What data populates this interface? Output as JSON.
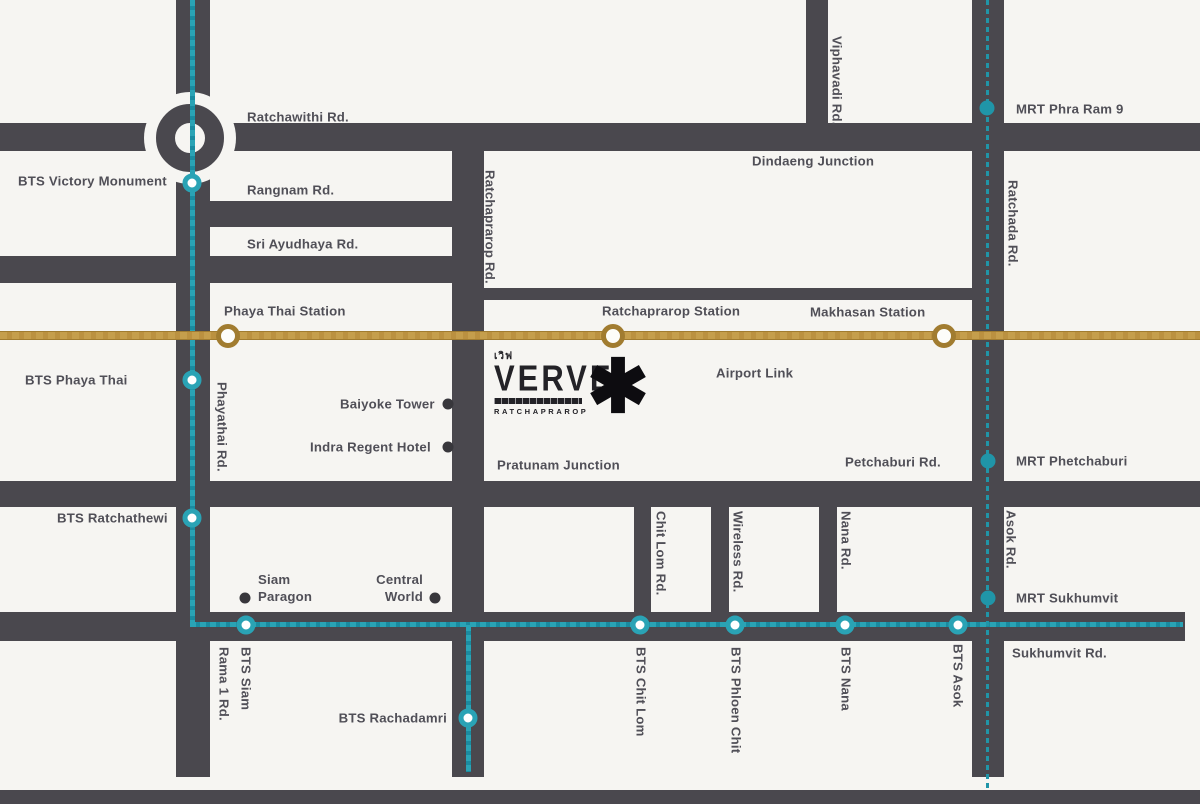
{
  "colors": {
    "road": "#4a484e",
    "bts": "#2aa3b5",
    "bts_dark": "#1a8ba0",
    "mrt": "#2095a8",
    "gold": "#bb9140",
    "gold_dark": "#a17c30",
    "text": "#504f57",
    "poi": "#38373c",
    "bg": "#f6f5f2",
    "logo_dark": "#232227"
  },
  "logo": {
    "thai": "เวิฟ",
    "name": "VERVE",
    "subtitle": "RATCHAPRAROP",
    "marker": "✱"
  },
  "labels": {
    "bts_victory_monument": "BTS Victory Monument",
    "ratchawithi_rd": "Ratchawithi Rd.",
    "rangnam_rd": "Rangnam Rd.",
    "sri_ayudhaya_rd": "Sri Ayudhaya Rd.",
    "viphavadi_rd": "Viphavadi Rd.",
    "mrt_phra_ram_9": "MRT Phra Ram 9",
    "dindaeng_junction": "Dindaeng Junction",
    "ratchada_rd": "Ratchada Rd.",
    "phaya_thai_station": "Phaya Thai Station",
    "ratchaprarop_station": "Ratchaprarop Station",
    "makhasan_station": "Makhasan Station",
    "airport_link": "Airport Link",
    "bts_phaya_thai": "BTS Phaya Thai",
    "phayathai_rd": "Phayathai Rd.",
    "ratchaprarop_rd": "Ratchaprarop Rd.",
    "baiyoke_tower": "Baiyoke Tower",
    "indra_regent_hotel": "Indra Regent Hotel",
    "pratunam_junction": "Pratunam Junction",
    "petchaburi_rd": "Petchaburi Rd.",
    "mrt_phetchaburi": "MRT Phetchaburi",
    "bts_ratchathewi": "BTS Ratchathewi",
    "siam_line1": "Siam",
    "siam_line2": "Paragon",
    "central_line1": "Central",
    "central_line2": "World",
    "chit_lom_rd": "Chit Lom Rd.",
    "wireless_rd": "Wireless Rd.",
    "nana_rd": "Nana Rd.",
    "asok_rd": "Asok Rd.",
    "mrt_sukhumvit": "MRT Sukhumvit",
    "sukhumvit_rd": "Sukhumvit Rd.",
    "bts_siam": "BTS Siam",
    "rama_1_rd": "Rama 1 Rd.",
    "bts_rachadamri": "BTS Rachadamri",
    "bts_chit_lom": "BTS Chit Lom",
    "bts_phloen_chit": "BTS Phloen Chit",
    "bts_nana": "BTS Nana",
    "bts_asok": "BTS Asok"
  }
}
